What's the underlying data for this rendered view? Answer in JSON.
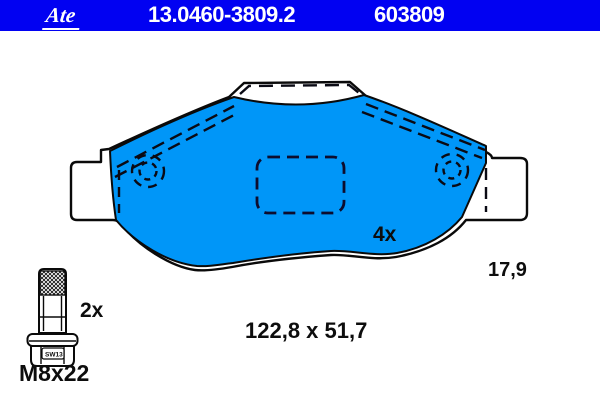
{
  "header": {
    "brand": "Ate",
    "part_number": "13.0460-3809.2",
    "article_number": "603809",
    "bar_color": "#0101f2",
    "text_color": "#ffffff"
  },
  "diagram": {
    "pad_fill_color": "#0096f8",
    "outline_color": "#0a0a0a",
    "quantity_label": "4x",
    "thickness_label": "17,9",
    "dimensions_label": "122,8 x 51,7"
  },
  "hardware": {
    "quantity_label": "2x",
    "size_label": "M8x22",
    "wrench_label": "SW13"
  }
}
